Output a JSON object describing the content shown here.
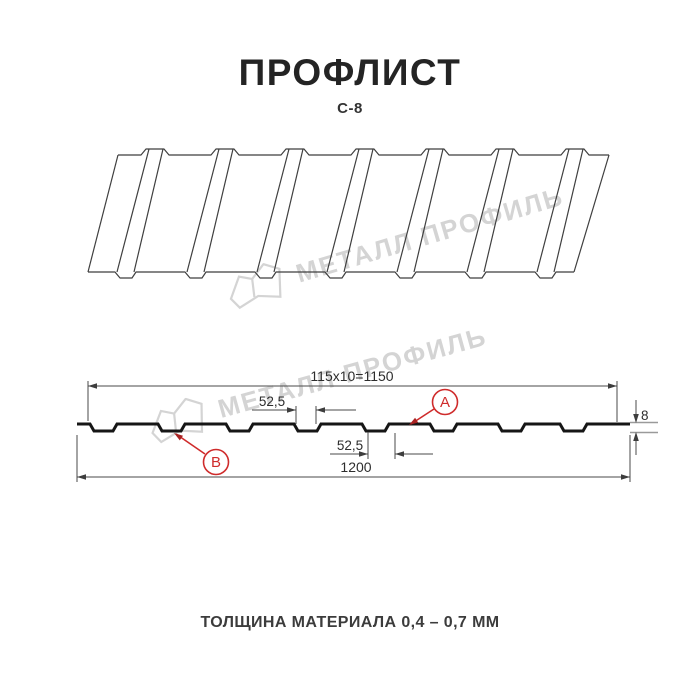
{
  "header": {
    "title": "ПРОФЛИСТ",
    "subtitle": "С-8"
  },
  "watermark": {
    "text": "МЕТАЛЛ ПРОФИЛЬ",
    "color": "#d4d4d4"
  },
  "dimensions": {
    "top_length": "115x10=1150",
    "flange_top": "52,5",
    "flange_bottom": "52,5",
    "overall_width": "1200",
    "profile_height": "8"
  },
  "markers": {
    "a": "А",
    "b": "В"
  },
  "footer": {
    "note": "ТОЛЩИНА МАТЕРИАЛА 0,4 – 0,7 ММ"
  },
  "colors": {
    "accent": "#cf2b2b",
    "dimension_line": "#4a4a4a",
    "profile_line": "#161616",
    "sheet_line": "#3f3f3f",
    "watermark": "#d4d4d4",
    "title_text": "#242424"
  }
}
